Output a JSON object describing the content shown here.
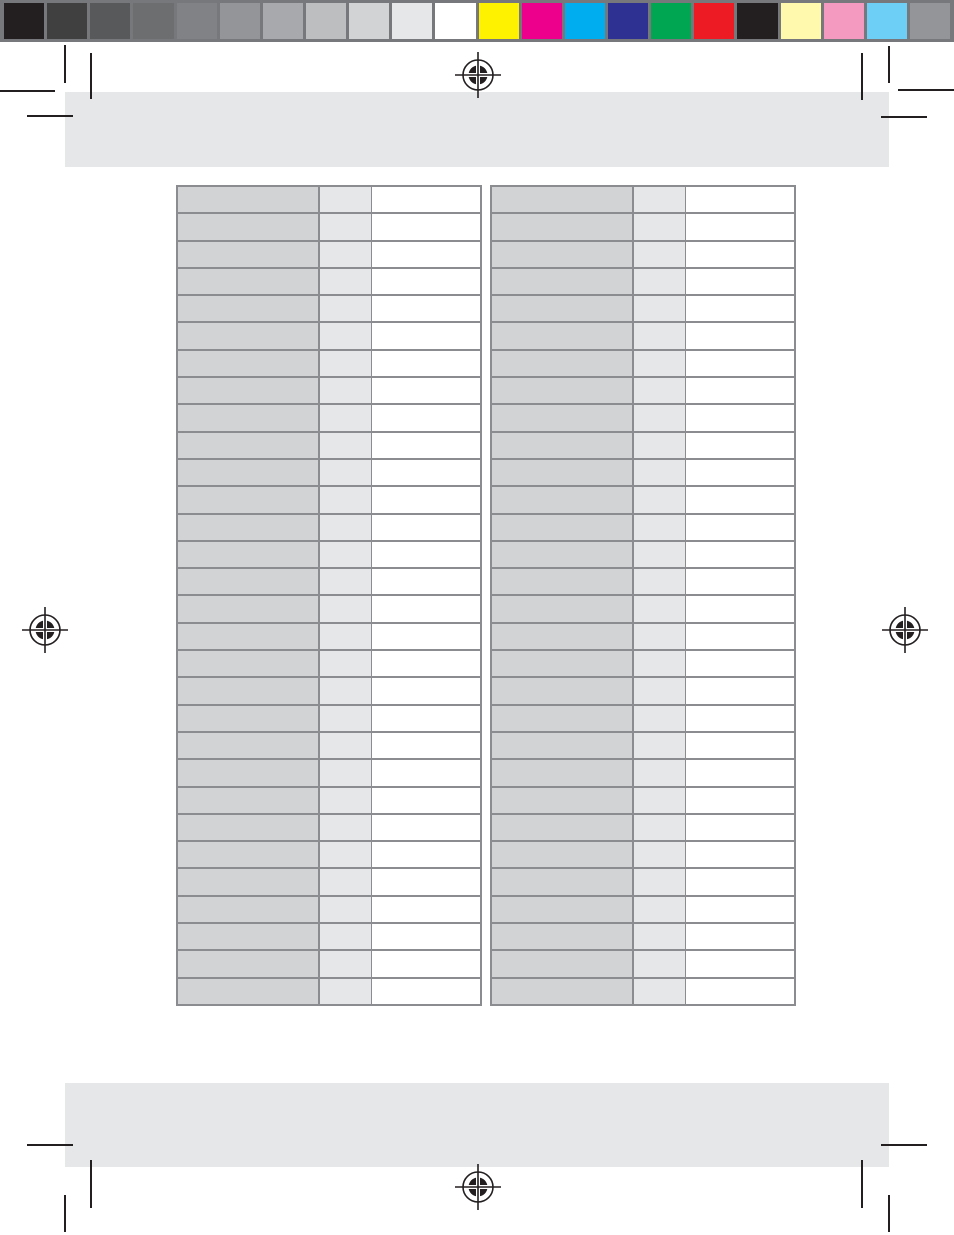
{
  "calibration_bar": {
    "background": "#77787b",
    "grayscale_swatches": [
      {
        "name": "gray-step-1",
        "color": "#231f20"
      },
      {
        "name": "gray-step-2",
        "color": "#404041"
      },
      {
        "name": "gray-step-3",
        "color": "#58595b"
      },
      {
        "name": "gray-step-4",
        "color": "#6d6e70"
      },
      {
        "name": "gray-step-5",
        "color": "#808285"
      },
      {
        "name": "gray-step-6",
        "color": "#939598"
      },
      {
        "name": "gray-step-7",
        "color": "#a7a9ac"
      },
      {
        "name": "gray-step-8",
        "color": "#bcbec0"
      },
      {
        "name": "gray-step-9",
        "color": "#d1d3d4"
      },
      {
        "name": "gray-step-10",
        "color": "#e6e7e8"
      },
      {
        "name": "gray-step-11",
        "color": "#ffffff"
      }
    ],
    "color_swatches": [
      {
        "name": "yellow",
        "color": "#fff200"
      },
      {
        "name": "magenta",
        "color": "#ec008c"
      },
      {
        "name": "cyan",
        "color": "#00aeef"
      },
      {
        "name": "dark-blue",
        "color": "#2e3192"
      },
      {
        "name": "green",
        "color": "#00a651"
      },
      {
        "name": "red",
        "color": "#ed1c24"
      },
      {
        "name": "black",
        "color": "#231f20"
      },
      {
        "name": "pale-yellow",
        "color": "#fff9ae"
      },
      {
        "name": "pink",
        "color": "#f49ac1"
      },
      {
        "name": "light-blue",
        "color": "#6dcff6"
      },
      {
        "name": "mid-gray",
        "color": "#939598"
      }
    ]
  },
  "registration_marks": [
    "top-center",
    "middle-left",
    "middle-right",
    "bottom-center"
  ],
  "header_placeholder": {
    "text": "",
    "fill": "#e6e7e8"
  },
  "footer_placeholder": {
    "text": "",
    "fill": "#e6e7e8"
  },
  "measurement_tables": {
    "row_count": 30,
    "columns": [
      {
        "name": "label-column",
        "fill": "#d1d3d4",
        "width": 142
      },
      {
        "name": "value-column",
        "fill": "#e6e7e8",
        "width": 52
      },
      {
        "name": "entry-column",
        "fill": "#ffffff",
        "width": 110
      }
    ],
    "border_color": "#8a8c8f",
    "cell_text": "",
    "tables": [
      {
        "id": "left",
        "rows": 30
      },
      {
        "id": "right",
        "rows": 30
      }
    ]
  },
  "crop_mark_color": "#231f20"
}
